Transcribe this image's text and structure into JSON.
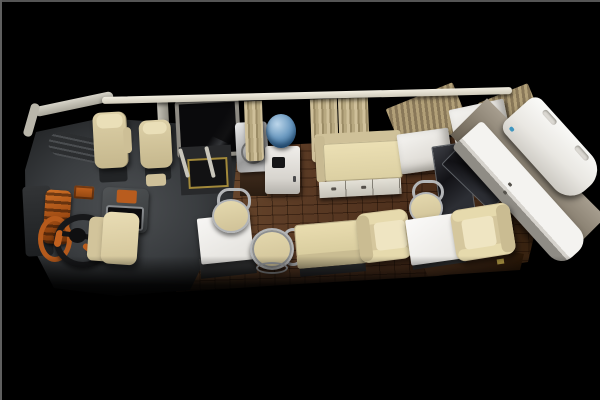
{
  "meta": {
    "title": "Motorhome interior cutaway",
    "description": "3D rendered top-down cutaway view of an RV bus interior on a black background",
    "image_type": "3d-render",
    "visible_text": ""
  },
  "palette": {
    "background": "#000000",
    "frame_line": "#5f5f5f",
    "wood_floor": "#5a3a24",
    "cab_gray": "#3a3d40",
    "dash_orange": "#b85c1e",
    "seat_cream": "#d8caa2",
    "cushion_light": "#e9ddb2",
    "rail_white": "#ece8db",
    "curtain_beige": "#c0b189",
    "blind_tan": "#a5946d",
    "white_furniture": "#f2f1ee",
    "counter_edge_gray": "#8f8c85",
    "glass_dark": "#17171b",
    "water_blue": "#4b7dab",
    "chrome": "#b4b6b8",
    "step_yellow": "#b2973f",
    "base_wood_dark": "#3a2312"
  },
  "objects": {
    "stage": {
      "label": "black backdrop"
    },
    "floor": {
      "label": "wood plank floor"
    },
    "cab": {
      "label": "driver cab platform"
    },
    "windshield": {
      "label": "windshield band"
    },
    "rail": {
      "label": "top wall rail"
    },
    "pillar": {
      "label": "door frame pillar"
    },
    "door_window": {
      "label": "entry door window"
    },
    "door_well": {
      "label": "entry step well"
    },
    "step": {
      "label": "step opening with yellow trim"
    },
    "grab_rail_1": {
      "label": "grab rail"
    },
    "grab_rail_2": {
      "label": "grab rail"
    },
    "sink": {
      "label": "stainless steel sink"
    },
    "sink_base": {
      "label": "sink base cabinet"
    },
    "bottle": {
      "label": "water cooler bottle"
    },
    "dispenser": {
      "label": "water dispenser cabinet"
    },
    "curtain_1": {
      "label": "window curtain"
    },
    "curtain_2": {
      "label": "window curtain"
    },
    "curtain_3": {
      "label": "window curtain"
    },
    "chaise": {
      "label": "chaise sofa with storage drawers"
    },
    "cabinet_1": {
      "label": "white storage cabinet"
    },
    "cabinet_2": {
      "label": "white overhead cabinet"
    },
    "partition": {
      "label": "dark glass partition"
    },
    "blind_a": {
      "label": "tan slat window blind"
    },
    "blind_b": {
      "label": "tan slat window blind"
    },
    "wall_band": {
      "label": "rear wall panel"
    },
    "cooktop": {
      "label": "dark glass cooktop"
    },
    "counter": {
      "label": "white kitchenette counter"
    },
    "rear_door": {
      "label": "open rear door panel"
    },
    "wood_base": {
      "label": "dark wood base cabinet"
    },
    "table_front": {
      "label": "white dining table"
    },
    "chair_front": {
      "label": "chrome cafe chair"
    },
    "stool_1": {
      "label": "round bar stool"
    },
    "bench": {
      "label": "bench seat"
    },
    "armchair_left": {
      "label": "cream armchair"
    },
    "stool_2": {
      "label": "round bar stool"
    },
    "table_rear": {
      "label": "white dining table"
    },
    "armchair_right": {
      "label": "cream armchair"
    },
    "dash_vent": {
      "label": "dashboard vent"
    },
    "cluster": {
      "label": "orange instrument cluster"
    },
    "wheel": {
      "label": "steering wheel"
    },
    "console": {
      "label": "center console with screen"
    },
    "driver_seat": {
      "label": "driver seat"
    },
    "pass_seat_1": {
      "label": "passenger seat"
    },
    "pass_seat_2": {
      "label": "passenger seat"
    },
    "jump_seat": {
      "label": "folding jump seat"
    },
    "side_box": {
      "label": "side storage box"
    }
  }
}
